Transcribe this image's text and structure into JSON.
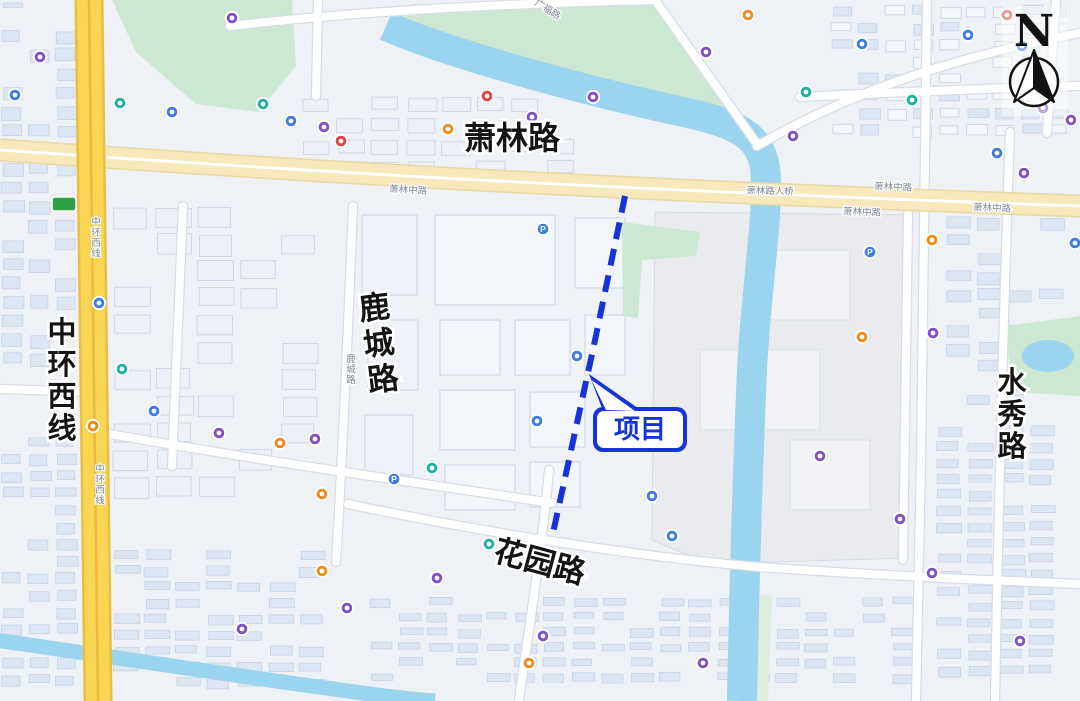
{
  "map": {
    "north": {
      "label": "N"
    },
    "callout": {
      "text": "项目",
      "color": "#1633d8"
    },
    "project_line": {
      "color": "#1633d8",
      "style": "dashed"
    },
    "major_road_labels": [
      {
        "text": "萧林路",
        "x": 512,
        "y": 149,
        "orient": "h",
        "size": 32,
        "rot": 0
      },
      {
        "text": "中环西线",
        "x": 62,
        "y": 342,
        "orient": "v",
        "size": 29,
        "rot": 0,
        "spacing": 32
      },
      {
        "text": "鹿城路",
        "x": 380,
        "y": 318,
        "orient": "v",
        "size": 31,
        "rot": -7,
        "spacing": 36
      },
      {
        "text": "水秀路",
        "x": 1012,
        "y": 392,
        "orient": "v",
        "size": 29,
        "rot": 0,
        "spacing": 32
      },
      {
        "text": "花园路",
        "x": 537,
        "y": 572,
        "orient": "h",
        "size": 31,
        "rot": 15
      }
    ],
    "small_road_labels": [
      {
        "text": "萧林中路",
        "x": 408,
        "y": 193,
        "rot": 3,
        "orient": "h"
      },
      {
        "text": "萧林路人桥",
        "x": 770,
        "y": 194,
        "rot": 1,
        "orient": "h"
      },
      {
        "text": "萧林中路",
        "x": 893,
        "y": 190,
        "rot": 2,
        "orient": "h"
      },
      {
        "text": "萧林中路",
        "x": 862,
        "y": 215,
        "rot": 2,
        "orient": "h"
      },
      {
        "text": "萧林中路",
        "x": 992,
        "y": 211,
        "rot": 2,
        "orient": "h"
      },
      {
        "text": "广福路",
        "x": 546,
        "y": 12,
        "rot": 32,
        "orient": "h"
      },
      {
        "text": "鹿城路",
        "x": 351,
        "y": 362,
        "orient": "v"
      },
      {
        "text": "中环西线",
        "x": 100,
        "y": 472,
        "orient": "v"
      },
      {
        "text": "中环西线",
        "x": 96,
        "y": 225,
        "orient": "v"
      }
    ],
    "route_shield": {
      "color": "#2e9e44",
      "x": 52,
      "y": 197
    },
    "poi_palette": {
      "pu": "#8050c8",
      "bl": "#3d7bea",
      "te": "#1fafa6",
      "or": "#f08a1d",
      "re": "#e2413d"
    },
    "poi_markers": [
      {
        "x": 15,
        "y": 95,
        "c": "bl"
      },
      {
        "x": 40,
        "y": 57,
        "c": "pu"
      },
      {
        "x": 120,
        "y": 103,
        "c": "te"
      },
      {
        "x": 172,
        "y": 112,
        "c": "bl"
      },
      {
        "x": 263,
        "y": 104,
        "c": "te"
      },
      {
        "x": 291,
        "y": 121,
        "c": "bl"
      },
      {
        "x": 324,
        "y": 127,
        "c": "pu"
      },
      {
        "x": 341,
        "y": 141,
        "c": "re"
      },
      {
        "x": 232,
        "y": 18,
        "c": "pu"
      },
      {
        "x": 448,
        "y": 129,
        "c": "or"
      },
      {
        "x": 487,
        "y": 96,
        "c": "re"
      },
      {
        "x": 532,
        "y": 117,
        "c": "pu"
      },
      {
        "x": 593,
        "y": 97,
        "c": "pu"
      },
      {
        "x": 706,
        "y": 52,
        "c": "pu"
      },
      {
        "x": 748,
        "y": 15,
        "c": "or"
      },
      {
        "x": 793,
        "y": 136,
        "c": "pu"
      },
      {
        "x": 806,
        "y": 92,
        "c": "te"
      },
      {
        "x": 862,
        "y": 44,
        "c": "bl"
      },
      {
        "x": 912,
        "y": 100,
        "c": "te"
      },
      {
        "x": 968,
        "y": 35,
        "c": "bl"
      },
      {
        "x": 1007,
        "y": 15,
        "c": "re"
      },
      {
        "x": 1022,
        "y": 46,
        "c": "bl"
      },
      {
        "x": 1043,
        "y": 108,
        "c": "pu"
      },
      {
        "x": 1071,
        "y": 120,
        "c": "pu"
      },
      {
        "x": 997,
        "y": 153,
        "c": "bl"
      },
      {
        "x": 1024,
        "y": 173,
        "c": "pu"
      },
      {
        "x": 1075,
        "y": 243,
        "c": "bl"
      },
      {
        "x": 932,
        "y": 240,
        "c": "or"
      },
      {
        "x": 870,
        "y": 252,
        "c": "bl",
        "g": "P"
      },
      {
        "x": 933,
        "y": 333,
        "c": "pu"
      },
      {
        "x": 862,
        "y": 337,
        "c": "or"
      },
      {
        "x": 820,
        "y": 456,
        "c": "pu"
      },
      {
        "x": 900,
        "y": 519,
        "c": "pu"
      },
      {
        "x": 99,
        "y": 303,
        "c": "bl"
      },
      {
        "x": 122,
        "y": 369,
        "c": "te"
      },
      {
        "x": 154,
        "y": 411,
        "c": "bl"
      },
      {
        "x": 93,
        "y": 426,
        "c": "or"
      },
      {
        "x": 219,
        "y": 433,
        "c": "pu"
      },
      {
        "x": 280,
        "y": 443,
        "c": "or"
      },
      {
        "x": 315,
        "y": 439,
        "c": "pu"
      },
      {
        "x": 322,
        "y": 494,
        "c": "or"
      },
      {
        "x": 394,
        "y": 479,
        "c": "bl",
        "g": "P"
      },
      {
        "x": 432,
        "y": 468,
        "c": "te"
      },
      {
        "x": 489,
        "y": 544,
        "c": "te"
      },
      {
        "x": 543,
        "y": 229,
        "c": "bl",
        "g": "P"
      },
      {
        "x": 577,
        "y": 356,
        "c": "bl"
      },
      {
        "x": 537,
        "y": 421,
        "c": "bl"
      },
      {
        "x": 652,
        "y": 496,
        "c": "bl"
      },
      {
        "x": 672,
        "y": 536,
        "c": "bl"
      },
      {
        "x": 322,
        "y": 571,
        "c": "or"
      },
      {
        "x": 347,
        "y": 608,
        "c": "pu"
      },
      {
        "x": 242,
        "y": 629,
        "c": "pu"
      },
      {
        "x": 437,
        "y": 578,
        "c": "pu"
      },
      {
        "x": 529,
        "y": 663,
        "c": "or"
      },
      {
        "x": 543,
        "y": 636,
        "c": "pu"
      },
      {
        "x": 703,
        "y": 663,
        "c": "pu"
      },
      {
        "x": 932,
        "y": 573,
        "c": "pu"
      },
      {
        "x": 1020,
        "y": 641,
        "c": "pu"
      }
    ]
  }
}
